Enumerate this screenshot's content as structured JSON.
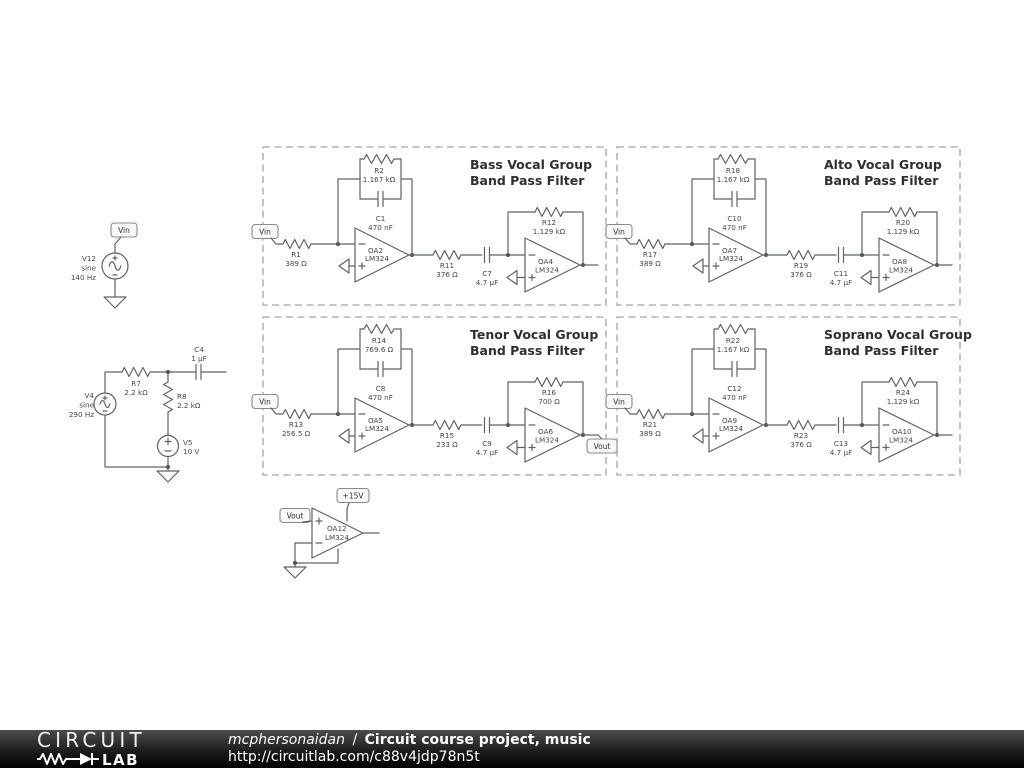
{
  "footer": {
    "logo_circuit": "CIRCUIT",
    "logo_lab": "LAB",
    "author": "mcphersonaidan",
    "separator": "/",
    "project_title": "Circuit course project, music",
    "url": "http://circuitlab.com/c88v4jdp78n5t"
  },
  "left_sources": {
    "vin_flag": "Vin",
    "v12": {
      "name": "V12",
      "kind": "sine",
      "freq": "140 Hz"
    },
    "v4": {
      "name": "V4",
      "kind": "sine",
      "freq": "290 Hz"
    },
    "r7": {
      "name": "R7",
      "value": "2.2 kΩ"
    },
    "c4": {
      "name": "C4",
      "value": "1 µF"
    },
    "r8": {
      "name": "R8",
      "value": "2.2 kΩ"
    },
    "v5": {
      "name": "V5",
      "value": "10 V"
    }
  },
  "filters": [
    {
      "title1": "Bass Vocal Group",
      "title2": "Band Pass Filter",
      "input_flag": "Vin",
      "r_in": {
        "name": "R1",
        "value": "389 Ω"
      },
      "r_fb": {
        "name": "R2",
        "value": "1.167 kΩ"
      },
      "c_fb": {
        "name": "C1",
        "value": "470 nF"
      },
      "oa_a": {
        "name": "OA2",
        "part": "LM324"
      },
      "r_mid": {
        "name": "R11",
        "value": "376 Ω"
      },
      "c_mid": {
        "name": "C7",
        "value": "4.7 µF"
      },
      "oa_b": {
        "name": "OA4",
        "part": "LM324"
      },
      "r_fb2": {
        "name": "R12",
        "value": "1.129 kΩ"
      }
    },
    {
      "title1": "Alto Vocal Group",
      "title2": "Band Pass Filter",
      "input_flag": "Vin",
      "r_in": {
        "name": "R17",
        "value": "389 Ω"
      },
      "r_fb": {
        "name": "R18",
        "value": "1.167 kΩ"
      },
      "c_fb": {
        "name": "C10",
        "value": "470 nF"
      },
      "oa_a": {
        "name": "OA7",
        "part": "LM324"
      },
      "r_mid": {
        "name": "R19",
        "value": "376 Ω"
      },
      "c_mid": {
        "name": "C11",
        "value": "4.7 µF"
      },
      "oa_b": {
        "name": "OA8",
        "part": "LM324"
      },
      "r_fb2": {
        "name": "R20",
        "value": "1.129 kΩ"
      }
    },
    {
      "title1": "Tenor Vocal Group",
      "title2": "Band Pass Filter",
      "input_flag": "Vin",
      "r_in": {
        "name": "R13",
        "value": "256.5 Ω"
      },
      "r_fb": {
        "name": "R14",
        "value": "769.6 Ω"
      },
      "c_fb": {
        "name": "C8",
        "value": "470 nF"
      },
      "oa_a": {
        "name": "OA5",
        "part": "LM324"
      },
      "r_mid": {
        "name": "R15",
        "value": "233 Ω"
      },
      "c_mid": {
        "name": "C9",
        "value": "4.7 µF"
      },
      "oa_b": {
        "name": "OA6",
        "part": "LM324"
      },
      "r_fb2": {
        "name": "R16",
        "value": "700 Ω"
      },
      "output_flag": "Vout"
    },
    {
      "title1": "Soprano Vocal Group",
      "title2": "Band Pass Filter",
      "input_flag": "Vin",
      "r_in": {
        "name": "R21",
        "value": "389 Ω"
      },
      "r_fb": {
        "name": "R22",
        "value": "1.167 kΩ"
      },
      "c_fb": {
        "name": "C12",
        "value": "470 nF"
      },
      "oa_a": {
        "name": "OA9",
        "part": "LM324"
      },
      "r_mid": {
        "name": "R23",
        "value": "376 Ω"
      },
      "c_mid": {
        "name": "C13",
        "value": "4.7 µF"
      },
      "oa_b": {
        "name": "OA10",
        "part": "LM324"
      },
      "r_fb2": {
        "name": "R24",
        "value": "1.129 kΩ"
      }
    }
  ],
  "output_stage": {
    "in_flag": "Vout",
    "supply_flag": "+15V",
    "oa": {
      "name": "OA12",
      "part": "LM324"
    }
  }
}
